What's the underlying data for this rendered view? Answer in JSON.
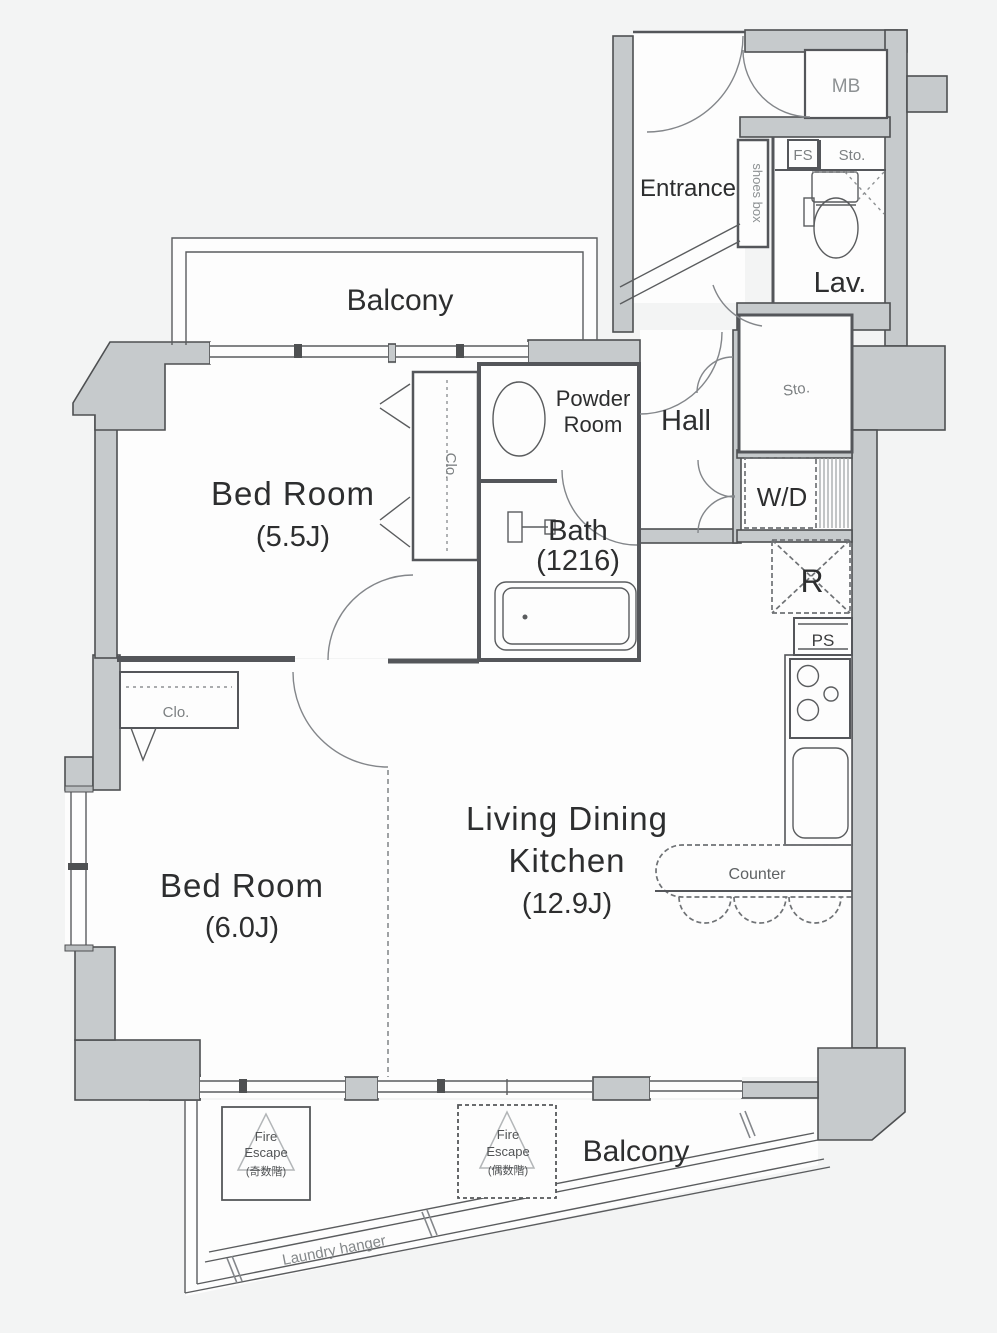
{
  "plan": {
    "labels": {
      "balcony_top": "Balcony",
      "balcony_bottom": "Balcony",
      "entrance": "Entrance",
      "mb": "MB",
      "fs": "FS",
      "sto_upper": "Sto.",
      "sto_hall": "Sto.",
      "shoes_box": "shoes box",
      "lav": "Lav.",
      "powder_room": [
        "Powder",
        "Room"
      ],
      "hall": "Hall",
      "bath": [
        "Bath",
        "(1216)"
      ],
      "wd": "W/D",
      "closet_bedroom1": "Clo.",
      "closet_bedroom2": "Clo.",
      "bedroom1": [
        "Bed Room",
        "(5.5J)"
      ],
      "bedroom2": [
        "Bed Room",
        "(6.0J)"
      ],
      "ldk": [
        "Living Dining",
        "Kitchen",
        "(12.9J)"
      ],
      "refrigerator": "R",
      "ps": "PS",
      "counter": "Counter",
      "fire_escape_odd": [
        "Fire",
        "Escape",
        "(奇数階)"
      ],
      "fire_escape_even": [
        "Fire",
        "Escape",
        "(偶数階)"
      ],
      "laundry_hanger": "Laundry hanger"
    },
    "colors": {
      "wall_fill": "#c6cacc",
      "wall_stroke": "#4e5052",
      "line": "#5a5c5e",
      "text_dark": "#2d2e2f",
      "text_gray": "#8d9193",
      "background": "#f3f4f4",
      "room_fill": "#fdfdfd"
    }
  }
}
